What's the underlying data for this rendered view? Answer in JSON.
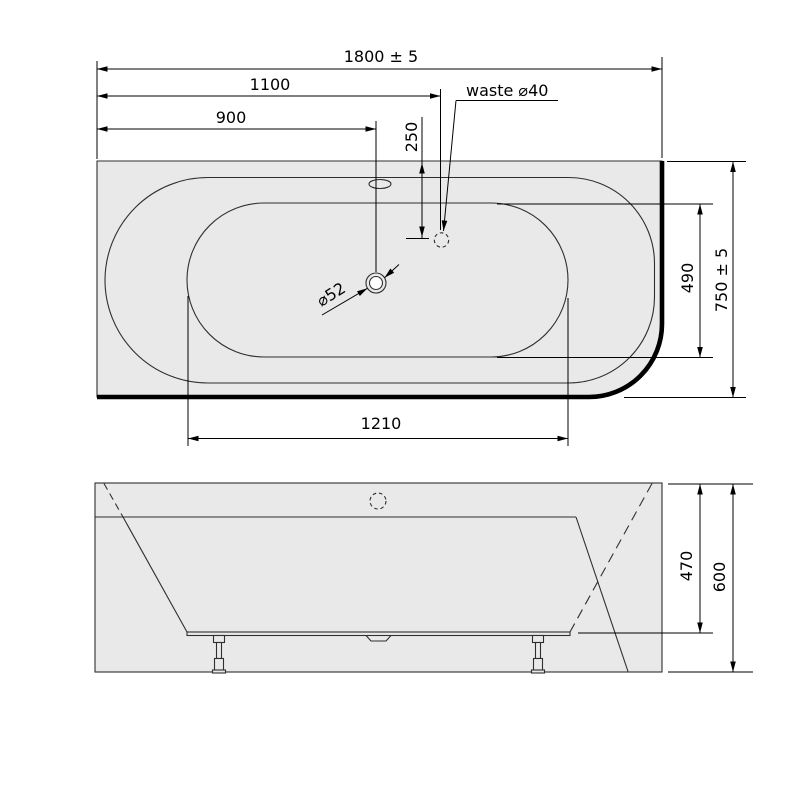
{
  "dims": {
    "top_width": "1800 ± 5",
    "len_1100": "1100",
    "len_900": "900",
    "offset_250": "250",
    "waste_label": "waste ⌀40",
    "drain_label": "⌀52",
    "depth": "750 ± 5",
    "inner_depth": "490",
    "inner_length": "1210",
    "height_470": "470",
    "height_600": "600"
  },
  "colors": {
    "tub_fill": "#e9e9e9",
    "line": "#2f2f2f",
    "dimension": "#000000",
    "background": "#ffffff"
  }
}
